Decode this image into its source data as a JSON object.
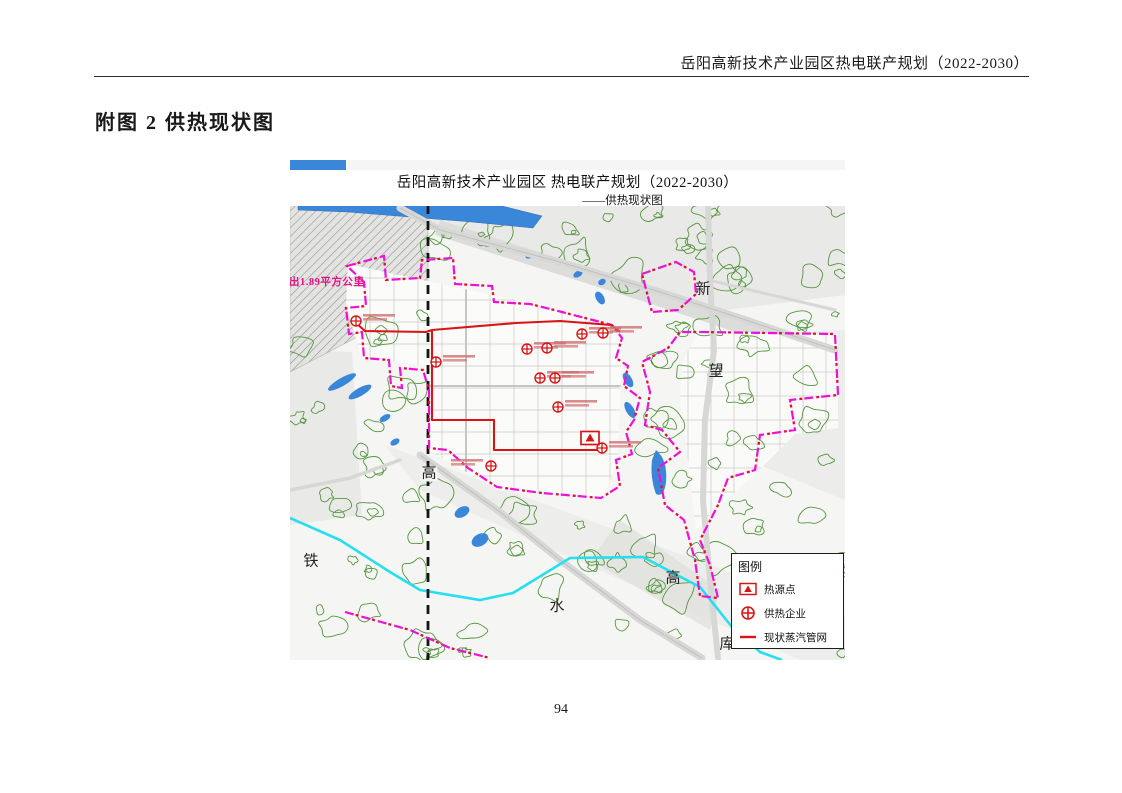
{
  "page": {
    "header_title": "岳阳高新技术产业园区热电联产规划（2022-2030）",
    "figure_caption": "附图 2 供热现状图",
    "page_number": "94"
  },
  "map": {
    "title": "岳阳高新技术产业园区 热电联产规划（2022-2030）",
    "subtitle": "——供热现状图",
    "area_note": "出1.89平方公里",
    "place_labels": [
      {
        "text": "新",
        "x": 413,
        "y": 130,
        "bg": false
      },
      {
        "text": "望",
        "x": 426,
        "y": 212,
        "bg": false
      },
      {
        "text": "高",
        "x": 139,
        "y": 314,
        "bg": true
      },
      {
        "text": "铁",
        "x": 21,
        "y": 402,
        "bg": false
      },
      {
        "text": "水",
        "x": 267,
        "y": 447,
        "bg": false
      },
      {
        "text": "高",
        "x": 383,
        "y": 419,
        "bg": false
      },
      {
        "text": "库",
        "x": 437,
        "y": 485,
        "bg": false
      }
    ],
    "legend": {
      "title": "图例",
      "items": [
        {
          "symbol": "heat-source-icon",
          "label": "热源点"
        },
        {
          "symbol": "heating-enterprise-icon",
          "label": "供热企业"
        },
        {
          "symbol": "steam-pipeline-icon",
          "label": "现状蒸汽管网"
        }
      ]
    },
    "markers": {
      "heat_source": {
        "x": 300,
        "y": 278
      },
      "enterprises": [
        {
          "x": 66,
          "y": 161
        },
        {
          "x": 146,
          "y": 202
        },
        {
          "x": 237,
          "y": 189
        },
        {
          "x": 257,
          "y": 188
        },
        {
          "x": 250,
          "y": 218
        },
        {
          "x": 265,
          "y": 218
        },
        {
          "x": 268,
          "y": 247
        },
        {
          "x": 292,
          "y": 174
        },
        {
          "x": 313,
          "y": 173
        },
        {
          "x": 201,
          "y": 306
        },
        {
          "x": 312,
          "y": 288
        }
      ]
    },
    "colors": {
      "boundary": "#ef0fd7",
      "boundary_dash": "#e01414",
      "pipeline": "#d81515",
      "water": "#3a87d9",
      "canal": "#25dff0",
      "vegetation": "#55963f",
      "railway": "#141414"
    }
  }
}
